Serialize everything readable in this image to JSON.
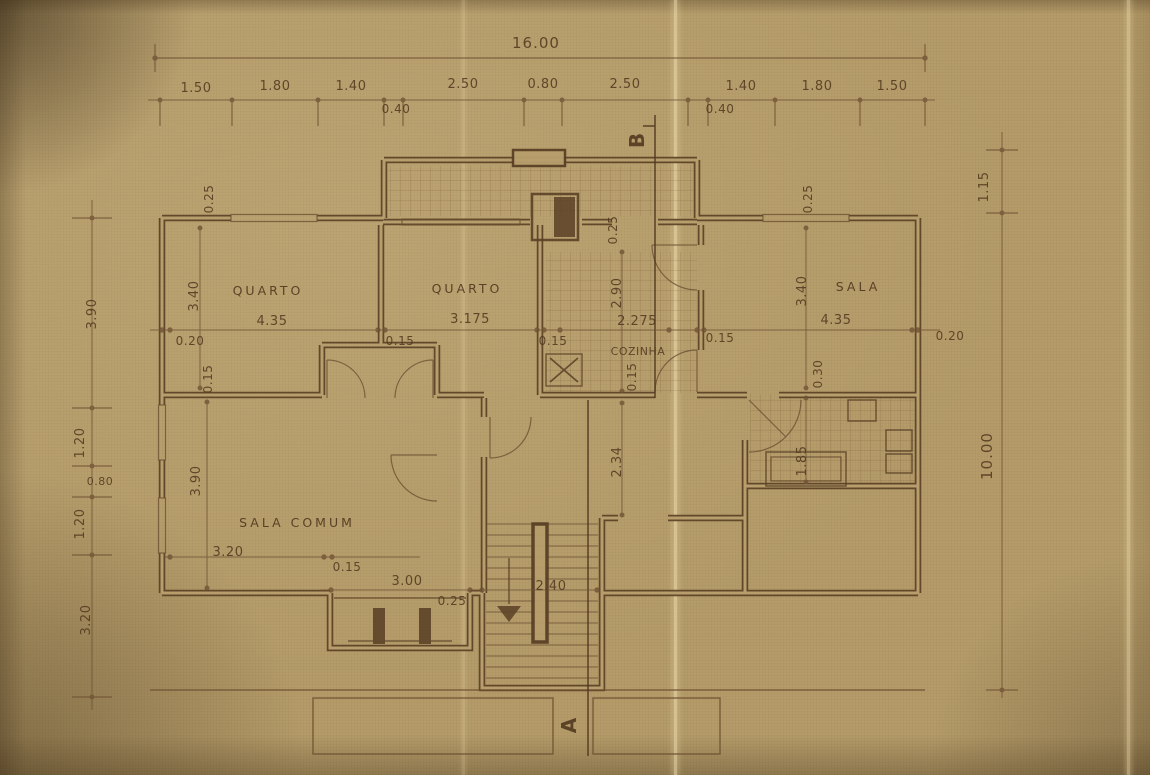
{
  "palette": {
    "paper": "#b49b69",
    "wall_ink": "#5a4126",
    "line_ink": "#6e5133",
    "text_ink": "#533a20",
    "crease": "#f2e2b2"
  },
  "plan": {
    "overall": {
      "width": "16.00",
      "height": "10.00",
      "right_upper": "1.15"
    },
    "top_chain": {
      "d0": "1.50",
      "d1": "1.80",
      "d2": "1.40",
      "d3": "2.50",
      "d4": "0.80",
      "d5": "2.50",
      "d6": "1.40",
      "d7": "1.80",
      "d8": "1.50",
      "sub0": "0.40",
      "sub1": "0.40"
    },
    "left_chain": {
      "d0": "3.90",
      "d1": "1.20",
      "d2": "0.80",
      "d3": "1.20",
      "d4": "3.20"
    },
    "rooms": {
      "quarto1": {
        "name": "QUARTO",
        "w": "4.35",
        "h": "3.40"
      },
      "quarto2": {
        "name": "QUARTO",
        "w": "3.175"
      },
      "cozinha": {
        "name": "COZINHA",
        "w": "2.275",
        "h": "2.90"
      },
      "sala": {
        "name": "SALA",
        "w": "4.35",
        "h": "3.40"
      },
      "sala_comum": {
        "name": "SALA COMUM",
        "h": "3.90",
        "d_left": "3.20",
        "d_right": "3.00"
      }
    },
    "walls": {
      "w0": "0.25",
      "w1": "0.25",
      "w2": "0.25",
      "w3": "0.20",
      "w4": "0.15",
      "w5": "0.15",
      "w6": "0.15",
      "w7": "0.15",
      "w8": "0.15",
      "w9": "0.20",
      "w10": "0.30",
      "w11": "0.15",
      "w12": "0.25"
    },
    "interior": {
      "hall_h": "2.34",
      "bath_h": "1.85",
      "stair_w": "2.40"
    },
    "sections": {
      "a": "A",
      "b": "B"
    }
  }
}
